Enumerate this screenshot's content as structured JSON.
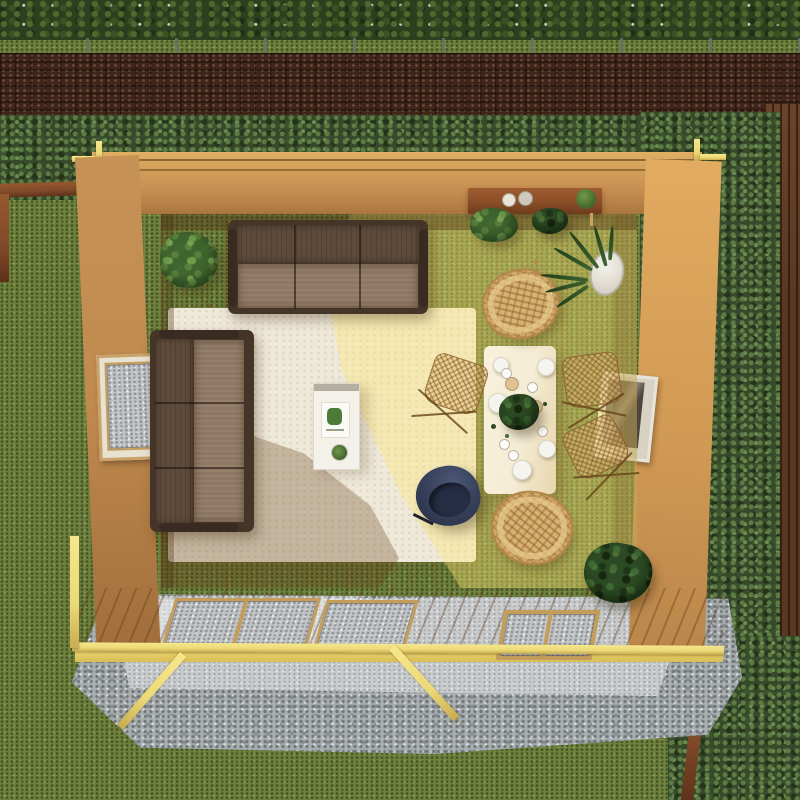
{
  "scene": {
    "title": "Aerial top-down render of a garden log cabin summerhouse interior",
    "setting": {
      "top": [
        "hedge",
        "stone coping",
        "brick wall",
        "conifer shrub border"
      ],
      "left": [
        "lawn grass",
        "timber planter edging"
      ],
      "right": [
        "conifer shrubs",
        "timber slatted fence",
        "planter edging"
      ],
      "bottom": [
        "gravel and concrete base pad",
        "lawn grass",
        "timber base bearers"
      ]
    },
    "cabin": {
      "shell": [
        "log wall top",
        "log wall left",
        "log wall right",
        "glazed front wall",
        "pine floor",
        "corner joint beams"
      ],
      "windows": [
        "left wall window",
        "right wall window",
        "front glazed panels and door"
      ],
      "furniture": [
        "three-seat brown leather sofa (top)",
        "three-seat brown leather sofa (left)",
        "cream area rug",
        "white coffee table with magazine and potted plant",
        "navy tub chair",
        "light wood dining table with plates and glasses",
        "rattan round chair (table head)",
        "rattan round chair (table foot)",
        "three wire-frame dining chairs with rattan seats",
        "wall console desk with two mugs and plant"
      ],
      "plants": [
        "corner potted plant (top-left)",
        "trailing plants under desk",
        "tall potted snake plant (right)",
        "corner potted plant (bottom-right)",
        "dining table centerpiece plant"
      ]
    }
  },
  "palette": {
    "grass": "#6e813d",
    "hedge": "#2c3f1e",
    "bush": "#36492b",
    "brick": "#40251a",
    "coping": "#cdd3ce",
    "fence": "#583823",
    "planter": "#80492a",
    "gravel": "#a9aeb0",
    "concrete": "#c8cbcc",
    "wallwood": "#c08a4e",
    "wallwooddark": "#9f6c3b",
    "beam": "#ecd977",
    "glass": "#c2c5c7",
    "rug": "#efe9d9",
    "sofaframe": "#453428",
    "sofaback": "#5f4b3b",
    "sofaseat": "#8e7763",
    "navy": "#38415c",
    "navydark": "#272e45",
    "wicker": "#d8b274",
    "tabletop": "#f4ecd4",
    "desk": "#8a4e28",
    "plant": "#3f652f",
    "plantdark": "#2c4a24"
  }
}
